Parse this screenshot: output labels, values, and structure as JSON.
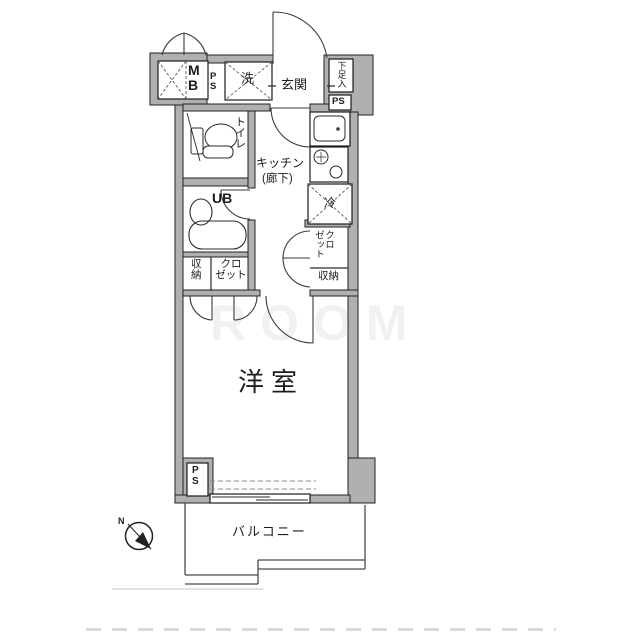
{
  "labels": {
    "meter_box": "M\nB",
    "ps_entry": "P\nS",
    "washer": "洗",
    "entrance": "玄関",
    "shoe_cabinet": "下足入",
    "ps_top_right": "PS",
    "toilet": "トイレ",
    "unit_bath": "UB",
    "kitchen": "キッチン",
    "kitchen_sub": "(廊下)",
    "fridge": "冷",
    "closet_right": "クロ\nゼット",
    "storage_right": "収納",
    "storage_left": "収\n納",
    "closet_left": "クロ\nゼット",
    "western_room": "洋室",
    "ps_bottom": "P\nS",
    "balcony": "バルコニー",
    "compass_north": "N",
    "watermark": "ROOM"
  },
  "colors": {
    "wall_fill": "#b0b0b0",
    "line": "#222222",
    "background": "#ffffff"
  }
}
